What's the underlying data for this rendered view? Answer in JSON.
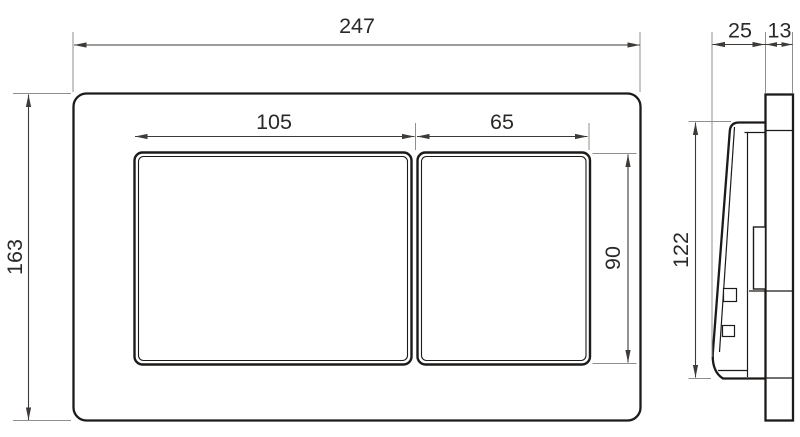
{
  "drawing": {
    "description": "Technical dimension drawing of a dual-flush wall plate, front view and side view",
    "views": {
      "front": {
        "name": "front-view",
        "dimensions": {
          "overall_width": "247",
          "overall_height": "163",
          "left_button_width": "105",
          "right_button_width": "65",
          "button_height": "90"
        }
      },
      "side": {
        "name": "side-view",
        "dimensions": {
          "button_depth": "25",
          "plate_depth": "13",
          "button_height": "122"
        }
      }
    },
    "colors": {
      "outline": "#1d1b19",
      "dimension_line": "#3d3a37",
      "extension_line": "#8f8f8d",
      "label_text": "#2b2927",
      "background": "#ffffff"
    }
  }
}
